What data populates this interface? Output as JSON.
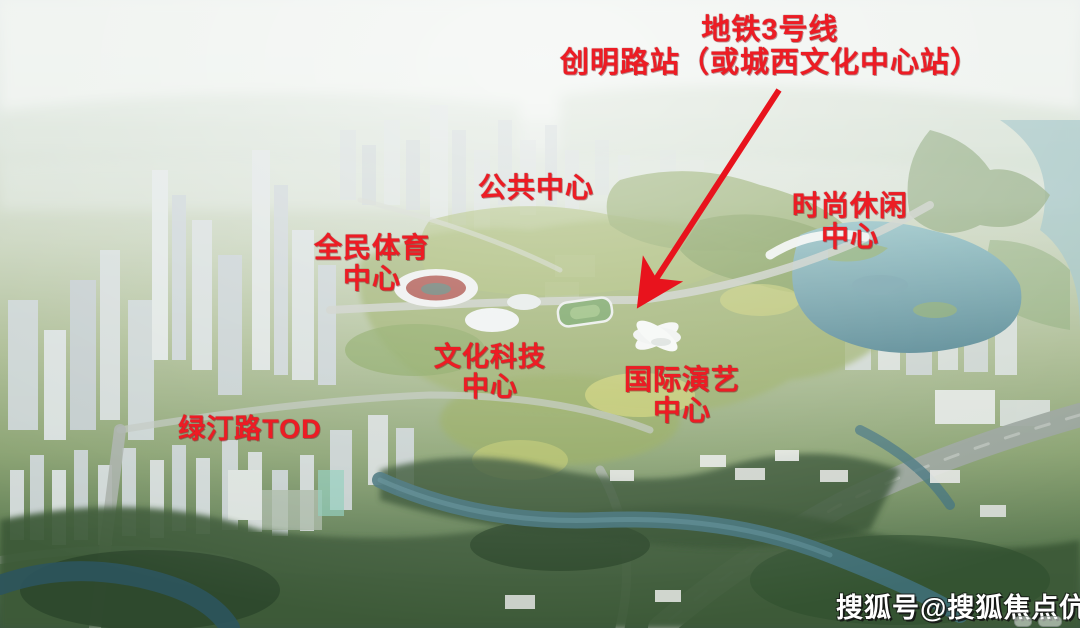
{
  "image_type": "aerial-masterplan-rendering",
  "callouts": [
    {
      "name": "metro-line3-station-title",
      "lines": [
        "地铁3号线",
        "创明路站（或城西文化中心站）"
      ]
    },
    {
      "name": "public-center",
      "lines": [
        "公共中心"
      ]
    },
    {
      "name": "national-sports-center",
      "lines": [
        "全民体育",
        "中心"
      ]
    },
    {
      "name": "fashion-leisure-center",
      "lines": [
        "时尚休闲",
        "中心"
      ]
    },
    {
      "name": "culture-technology-center",
      "lines": [
        "文化科技",
        "中心"
      ]
    },
    {
      "name": "international-performing-arts-center",
      "lines": [
        "国际演艺",
        "中心"
      ]
    },
    {
      "name": "lvting-road-tod",
      "lines": [
        "绿汀路TOD"
      ]
    }
  ],
  "watermark": {
    "text": "搜狐号@搜狐焦点伉安站"
  },
  "colors": {
    "annotation_red": "#ed1c24",
    "arrow_red": "#e8131d",
    "watermark_white": "#ffffff",
    "haze_sky": "#e8edea",
    "park_green": "#8fa657",
    "deep_tree_green": "#33502f",
    "lake_teal": "#7fb2b6",
    "channel_teal": "#3f6f78",
    "building_grey": "#d3dad8"
  }
}
